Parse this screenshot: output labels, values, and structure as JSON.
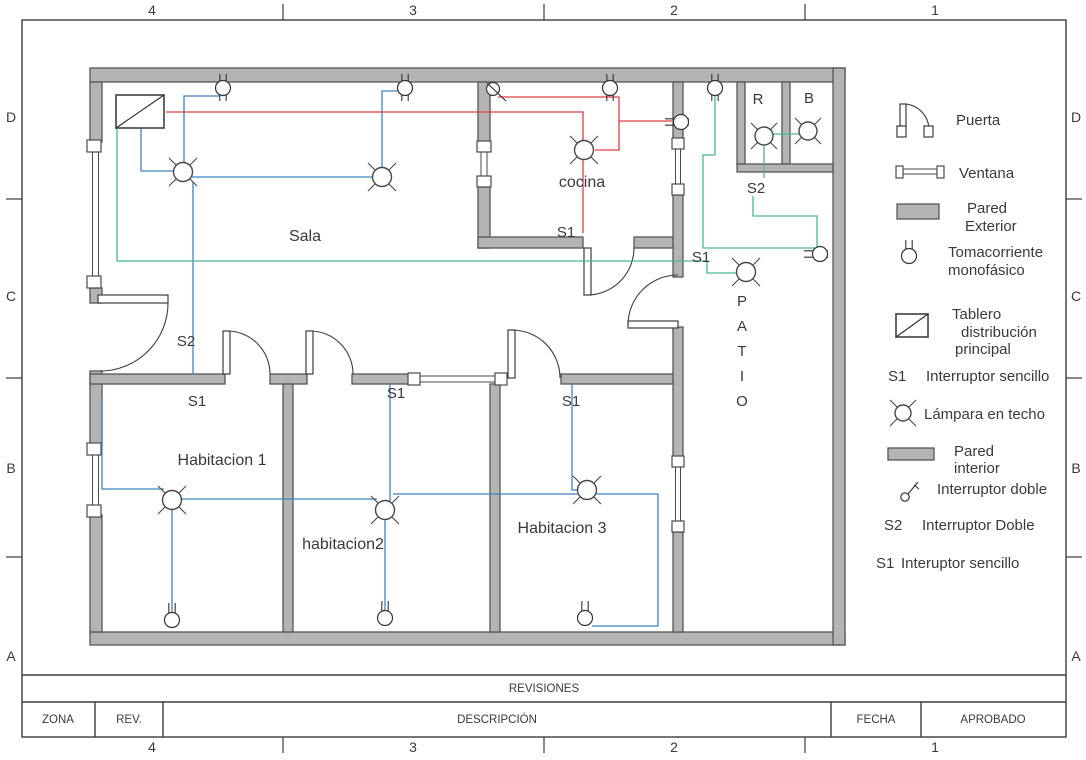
{
  "colors": {
    "wire_blue": "#3f84c4",
    "wire_red": "#dd4040",
    "wire_green": "#49b98c",
    "wall_fill": "#b4b4b4",
    "line": "#3c3c3c"
  },
  "frame": {
    "cols": [
      "4",
      "3",
      "2",
      "1"
    ],
    "rows": [
      "D",
      "C",
      "B",
      "A"
    ]
  },
  "plan": {
    "rooms": {
      "sala": "Sala",
      "cocina": "cocina",
      "hab1": "Habitacion 1",
      "hab2": "habitacion2",
      "hab3": "Habitacion 3",
      "r": "R",
      "b": "B"
    },
    "patio": [
      "P",
      "A",
      "T",
      "I",
      "O"
    ],
    "switches": {
      "s2_sala": "S2",
      "s1_sala": "S1",
      "s1_hab2": "S1",
      "s1_hab3": "S1",
      "s1_cocina": "S1",
      "s1_patio": "S1",
      "s2_patio": "S2"
    }
  },
  "legend": {
    "door": "Puerta",
    "window": "Ventana",
    "ext_wall_1": "Pared",
    "ext_wall_2": "Exterior",
    "outlet_1": "Tomacorriente",
    "outlet_2": "monofásico",
    "panel_1": "Tablero",
    "panel_2": "distribución",
    "panel_3": "principal",
    "s1_key": "S1",
    "s1_label": "Interruptor sencillo",
    "lamp": "Lámpara en techo",
    "int_wall_1": "Pared",
    "int_wall_2": "interior",
    "double_switch": "Interruptor doble",
    "s2_key": "S2",
    "s2_label": "Interruptor Doble",
    "s1b_key": "S1",
    "s1b_label": "Interuptor sencillo"
  },
  "title_block": {
    "header": "REVISIONES",
    "zona": "ZONA",
    "rev": "REV.",
    "descripcion": "DESCRIPCIÓN",
    "fecha": "FECHA",
    "aprobado": "APROBADO"
  }
}
